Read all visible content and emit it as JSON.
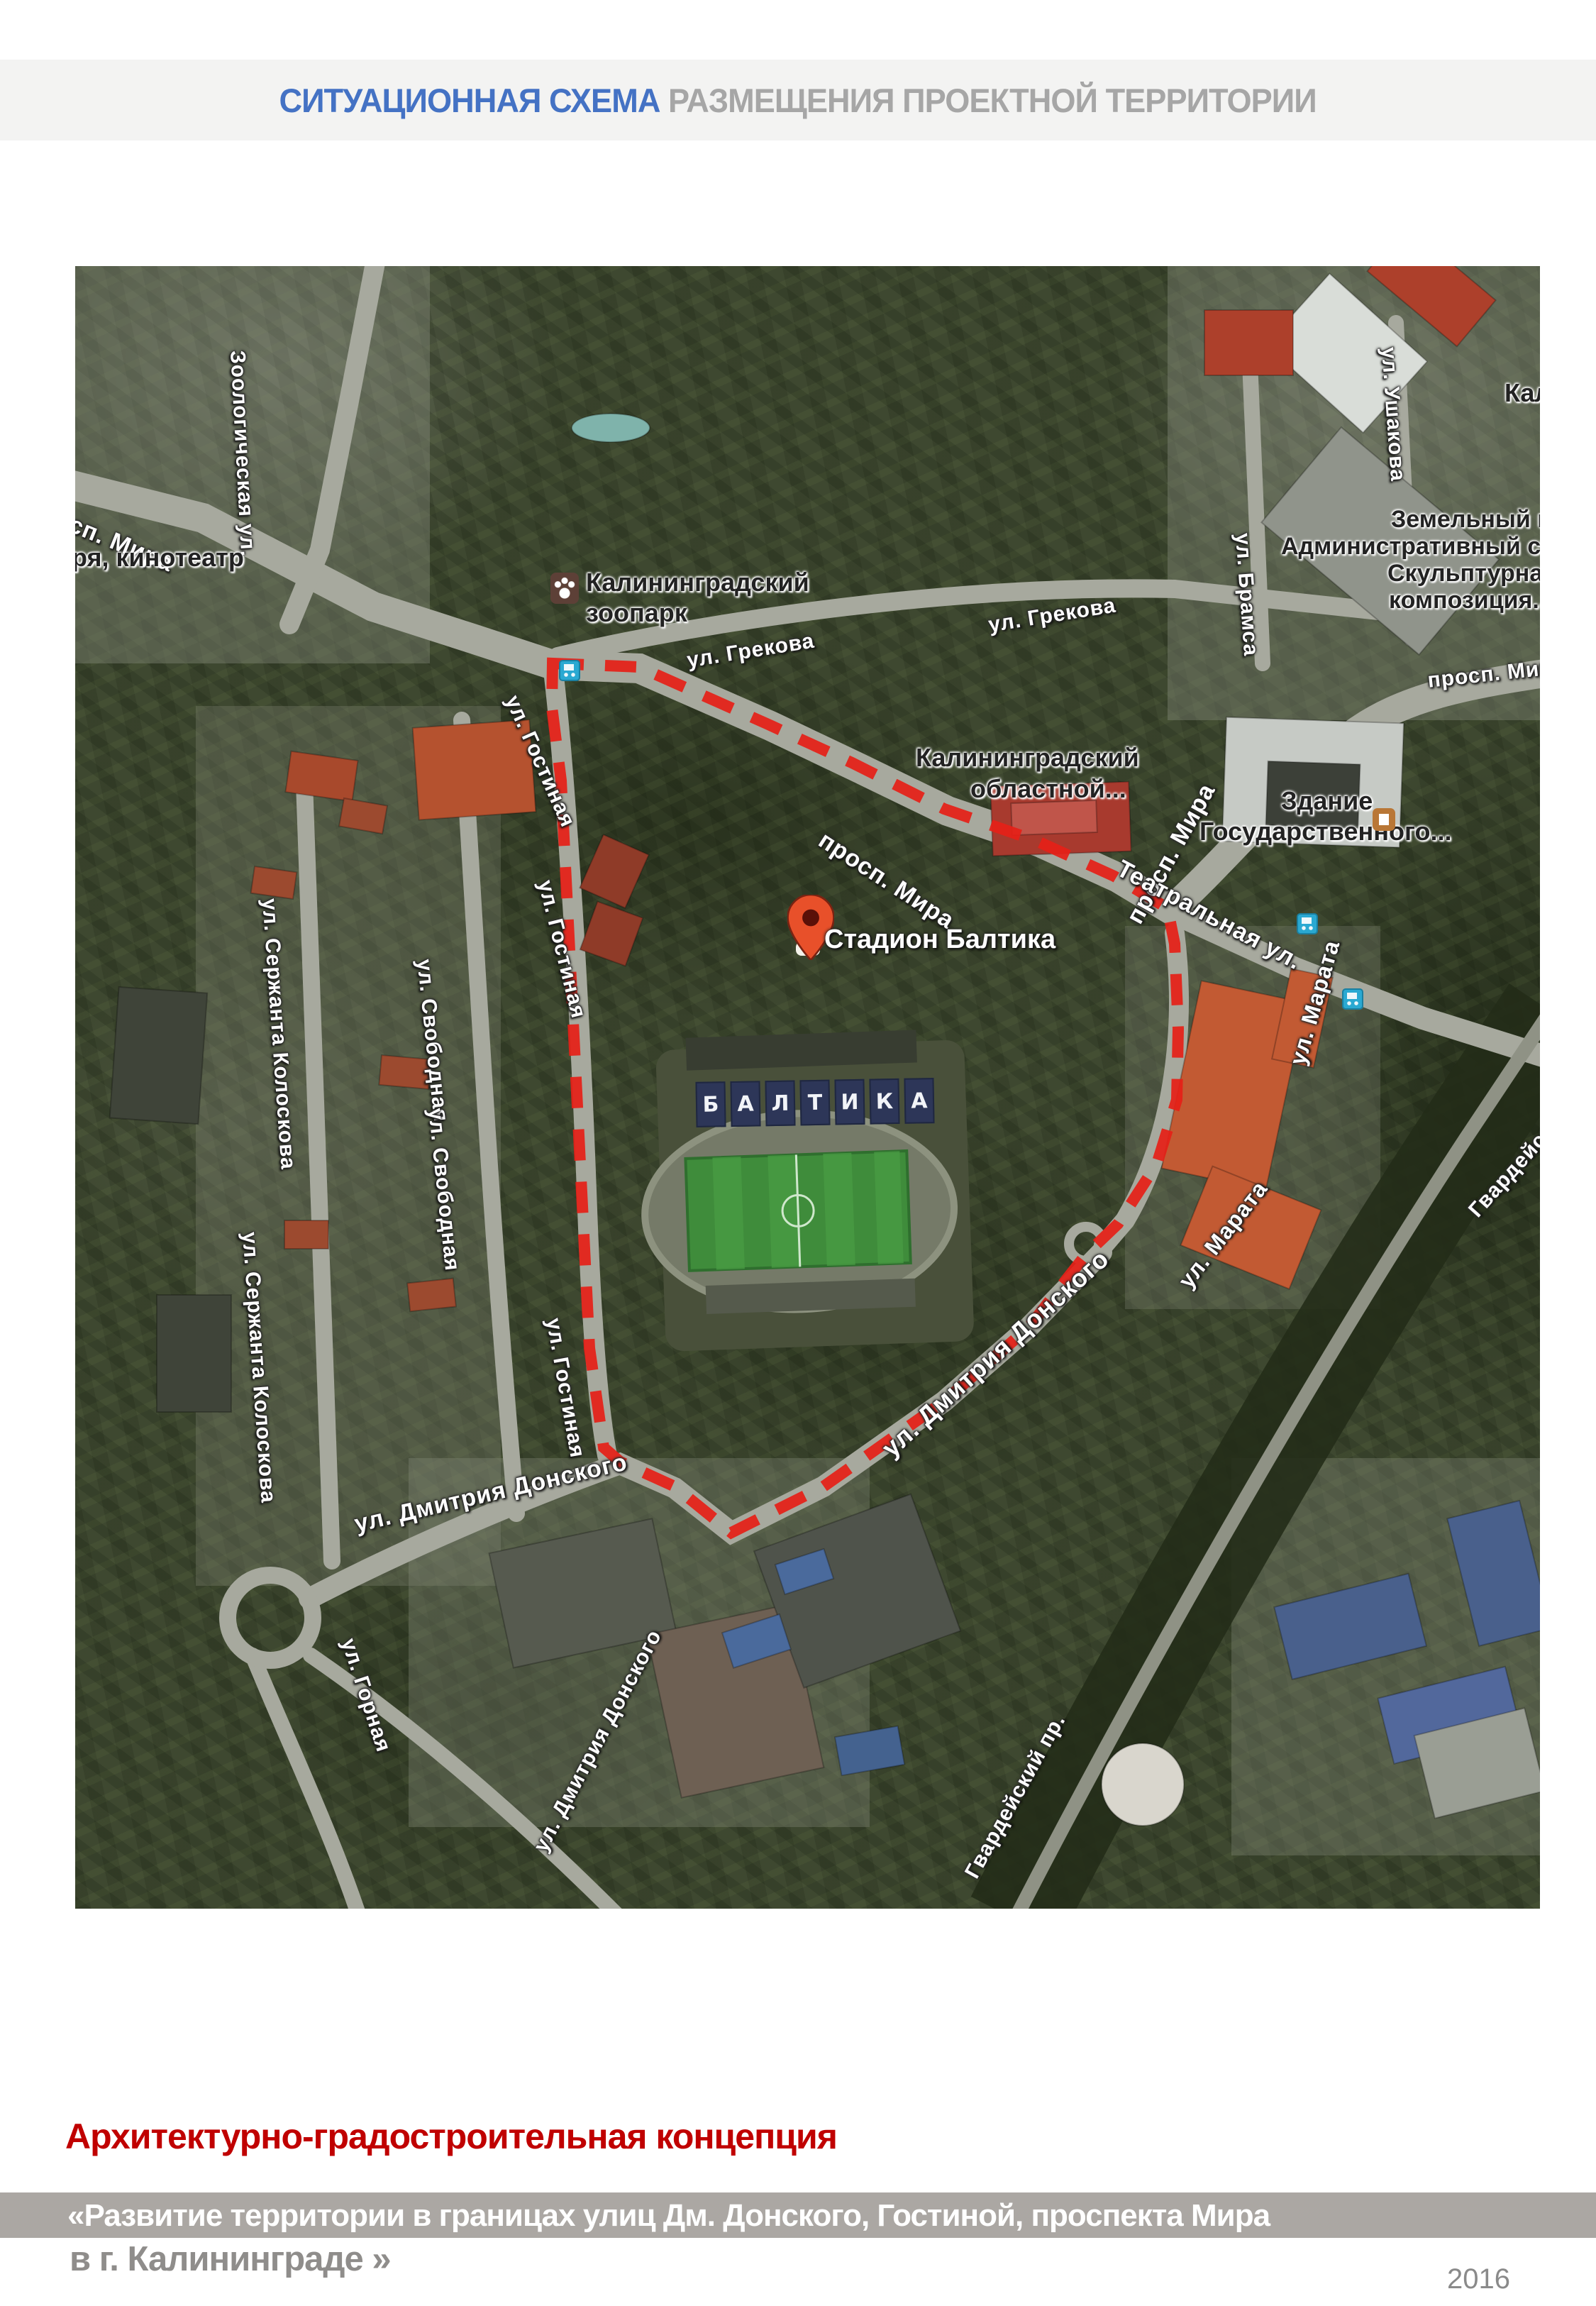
{
  "header": {
    "title_blue": "СИТУАЦИОННАЯ СХЕМА",
    "title_gray": " РАЗМЕЩЕНИЯ ПРОЕКТНОЙ ТЕРРИТОРИИ"
  },
  "map": {
    "road_labels": [
      {
        "text": "Зоологическая ул."
      },
      {
        "text": "сп. Мира"
      },
      {
        "text": "просп. Мира"
      },
      {
        "text": "ул. Грекова"
      },
      {
        "text": "ул. Грекова"
      },
      {
        "text": "просп. Мира"
      },
      {
        "text": "просп. Мира"
      },
      {
        "text": "Театральная ул."
      },
      {
        "text": "ул. Ушакова"
      },
      {
        "text": "ул. Брамса"
      },
      {
        "text": "ул. Гостиная"
      },
      {
        "text": "ул. Гостиная"
      },
      {
        "text": "ул. Гостиная"
      },
      {
        "text": "ул. Свободная"
      },
      {
        "text": "ул. Свободная"
      },
      {
        "text": "ул. Сержанта Колоскова"
      },
      {
        "text": "ул. Сержанта Колоскова"
      },
      {
        "text": "ул. Дмитрия Донского"
      },
      {
        "text": "ул. Дмитрия Донского"
      },
      {
        "text": "ул. Дмитрия Донского"
      },
      {
        "text": "ул. Горная"
      },
      {
        "text": "ул. Марата"
      },
      {
        "text": "ул. Марата"
      },
      {
        "text": "Гвардейский пр."
      },
      {
        "text": "Гвардейский пр."
      }
    ],
    "poi_labels": [
      {
        "text": "ря, кинотеатр"
      },
      {
        "text": "Калининградский"
      },
      {
        "text": "зоопарк"
      },
      {
        "text": "Калининградский"
      },
      {
        "text": "областной..."
      },
      {
        "text": "Здание"
      },
      {
        "text": "Государственного..."
      },
      {
        "text": "Земельный и"
      },
      {
        "text": "Административный суд"
      },
      {
        "text": "Скульптурная"
      },
      {
        "text": "композиция..."
      },
      {
        "text": "Кал"
      }
    ],
    "marker": {
      "label": "Стадион Балтика"
    },
    "stadium_letters": [
      "Б",
      "А",
      "Л",
      "Т",
      "И",
      "К",
      "А"
    ],
    "icons": [
      "map-pin-icon",
      "zoo-paw-icon",
      "transit-stop-icon",
      "government-building-icon"
    ]
  },
  "footer": {
    "concept_title": "Архитектурно-градостроительная концепция",
    "band_line1": "«Развитие территории в границах улиц Дм. Донского, Гостиной, проспекта Мира",
    "band_line2": "в г. Калининграде »",
    "year": "2016"
  },
  "colors": {
    "accent_blue": "#4472C4",
    "accent_gray": "#A6A6A6",
    "title_red": "#C00000",
    "band_bg": "#ABA7A3",
    "boundary_red": "#E52018"
  }
}
